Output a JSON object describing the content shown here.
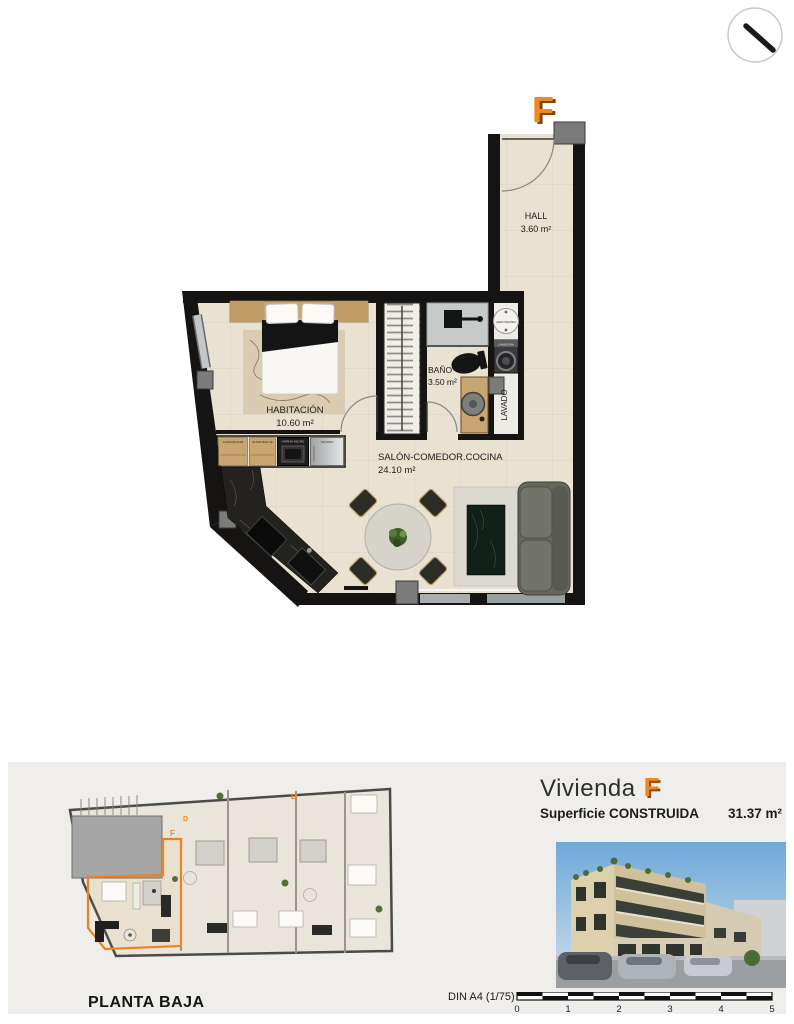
{
  "badge": {
    "letter": "F"
  },
  "floor_plan": {
    "hall": {
      "name": "HALL",
      "area": "3.60 m²"
    },
    "bath": {
      "name": "BAÑO",
      "area": "3.50 m²"
    },
    "bedroom": {
      "name": "HABITACIÓN",
      "area": "10.60 m²"
    },
    "living": {
      "name": "SALÓN-COMEDOR.COCINA",
      "area": "24.10 m²"
    },
    "laundry": {
      "label": "LAVADO",
      "heater": "AEROTERMIA",
      "washer": "LAVADORA"
    },
    "kitchen_units": [
      "ALMACENAJE",
      "ALMACENAJE",
      "HORNO MICRO",
      "NEVERA"
    ]
  },
  "site_plan": {
    "title": "PLANTA BAJA",
    "letters": {
      "d": "D",
      "e": "E",
      "f": "F"
    }
  },
  "summary": {
    "dwelling_label": "Vivienda",
    "dwelling_unit": "F",
    "surface_label": "Superficie CONSTRUIDA",
    "surface_value": "31.37 m²"
  },
  "scale": {
    "label": "DIN A4 (1/75)",
    "ticks": [
      "0",
      "1",
      "2",
      "3",
      "4",
      "5"
    ]
  },
  "colors": {
    "accent": "#ee8722",
    "accent_dark": "#8a4c0a",
    "wall": "#161412",
    "floor": "#e9e1d1",
    "panel_bg": "#f0eeea"
  }
}
